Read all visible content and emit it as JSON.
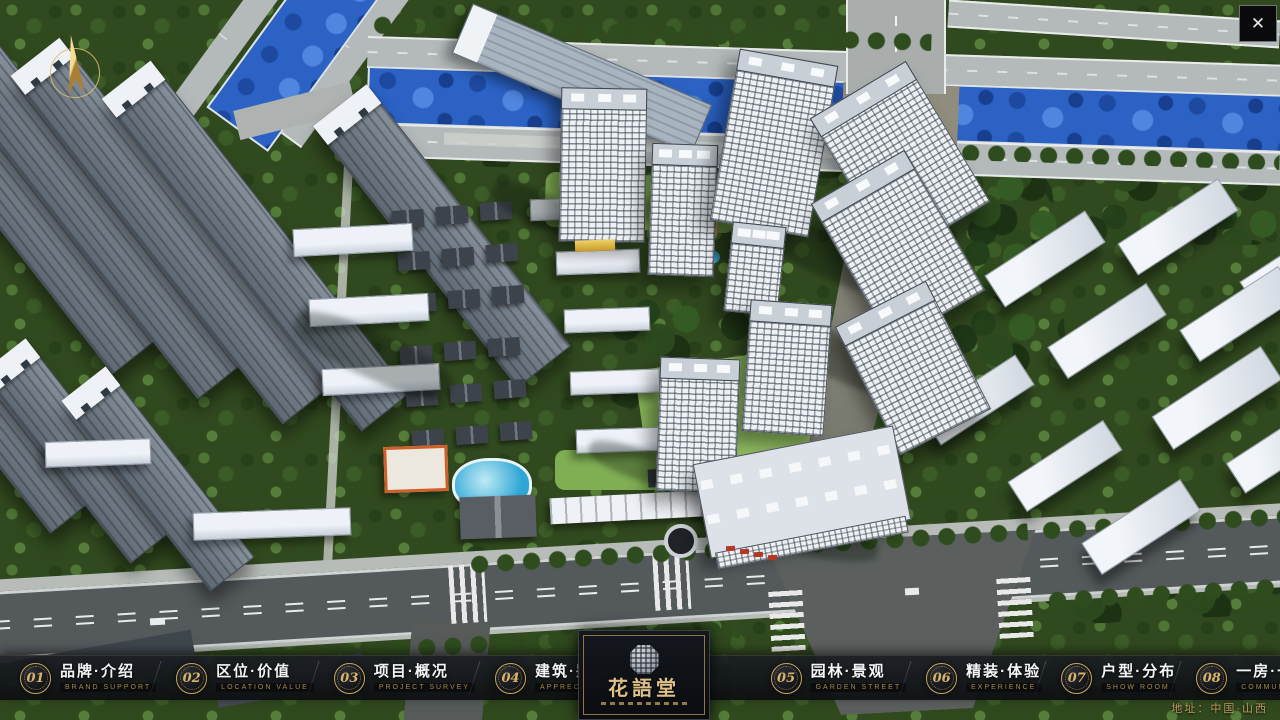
{
  "window": {
    "close_icon": "✕"
  },
  "map": {
    "address_label": "地址：中国·山西"
  },
  "brand": {
    "name": "花語堂"
  },
  "menu": {
    "items": [
      {
        "number": "01",
        "label": "品牌·介绍",
        "caption": "BRAND SUPPORT"
      },
      {
        "number": "02",
        "label": "区位·价值",
        "caption": "LOCATION VALUE"
      },
      {
        "number": "03",
        "label": "项目·概况",
        "caption": "PROJECT SURVEY"
      },
      {
        "number": "04",
        "label": "建筑·鉴赏",
        "caption": "APPRECIATION"
      },
      {
        "number": "05",
        "label": "园林·景观",
        "caption": "GARDEN STREET"
      },
      {
        "number": "06",
        "label": "精装·体验",
        "caption": "EXPERIENCE"
      },
      {
        "number": "07",
        "label": "户型·分布",
        "caption": "SHOW ROOM"
      },
      {
        "number": "08",
        "label": "一房·一景",
        "caption": "COMMUNITY"
      }
    ]
  },
  "colors": {
    "gold_accent": "#c8a75d",
    "bar_background": "#14161a",
    "river_blue": "#2b62c4"
  }
}
